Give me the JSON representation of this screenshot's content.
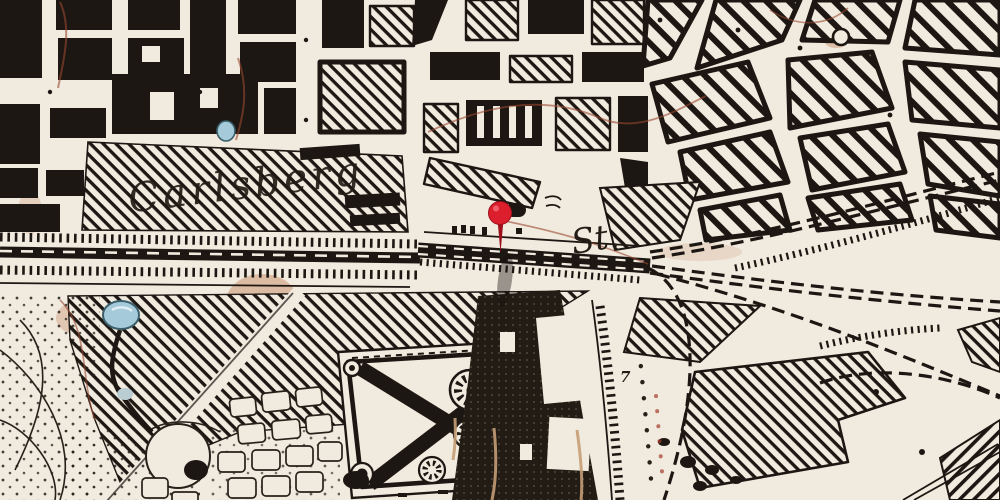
{
  "map": {
    "labels": {
      "brewery": "Carlsberg",
      "station_suffix": "St.",
      "plot_number": "7"
    },
    "marker": {
      "kind": "red-pin",
      "x": 500,
      "y": 213
    },
    "colors": {
      "paper": "#f1eadf",
      "ink": "#1c1712",
      "pin_red": "#dd1f2d",
      "pin_rim": "#9e0f1c",
      "pond_blue": "#a5cbda",
      "stain_sepia": "#b4602f"
    }
  }
}
